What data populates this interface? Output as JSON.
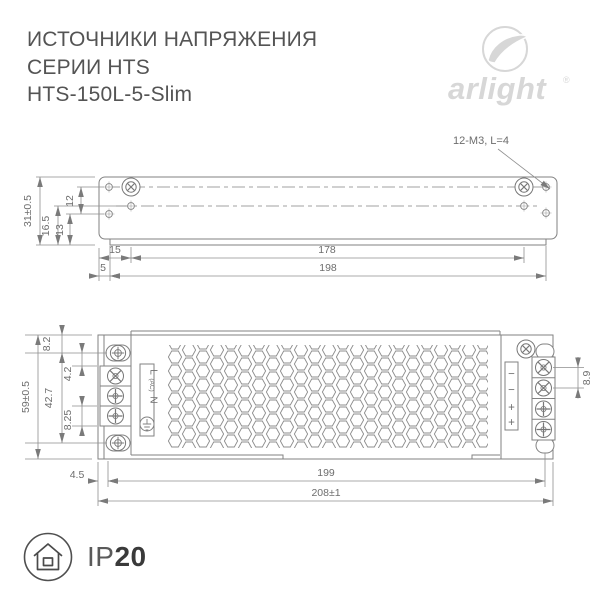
{
  "header": {
    "title_line1": "ИСТОЧНИКИ НАПРЯЖЕНИЯ",
    "title_line2": "СЕРИИ HTS",
    "title_line3": "HTS-150L-5-Slim"
  },
  "logo": {
    "brand": "arlight",
    "registered": "®"
  },
  "top_view": {
    "annotation": "12-M3, L=4",
    "dims": {
      "height": "31±0.5",
      "left_165": "16.5",
      "left_13": "13",
      "left_12": "12",
      "w15": "15",
      "w178": "178",
      "w5": "5",
      "w198": "198"
    }
  },
  "bottom_view": {
    "dims": {
      "height": "59±0.5",
      "v82": "8.2",
      "v427": "42.7",
      "v42": "4.2",
      "v825": "8.25",
      "v89": "8.9",
      "w45": "4.5",
      "w199": "199",
      "w208": "208±1"
    },
    "ac_labels": {
      "line": "L",
      "ac": "(AC)",
      "neutral": "N"
    },
    "dc_labels": {
      "minus1": "−",
      "minus2": "−",
      "plus1": "+",
      "plus2": "+"
    }
  },
  "footer": {
    "ip_prefix": "IP",
    "ip_rating": "20"
  },
  "colors": {
    "drawing_line": "#828282",
    "dimension_text": "#6d6d6d",
    "title_text": "#545454",
    "logo_gray": "#d7d7d7",
    "badge_dark": "#3a3a3a"
  }
}
